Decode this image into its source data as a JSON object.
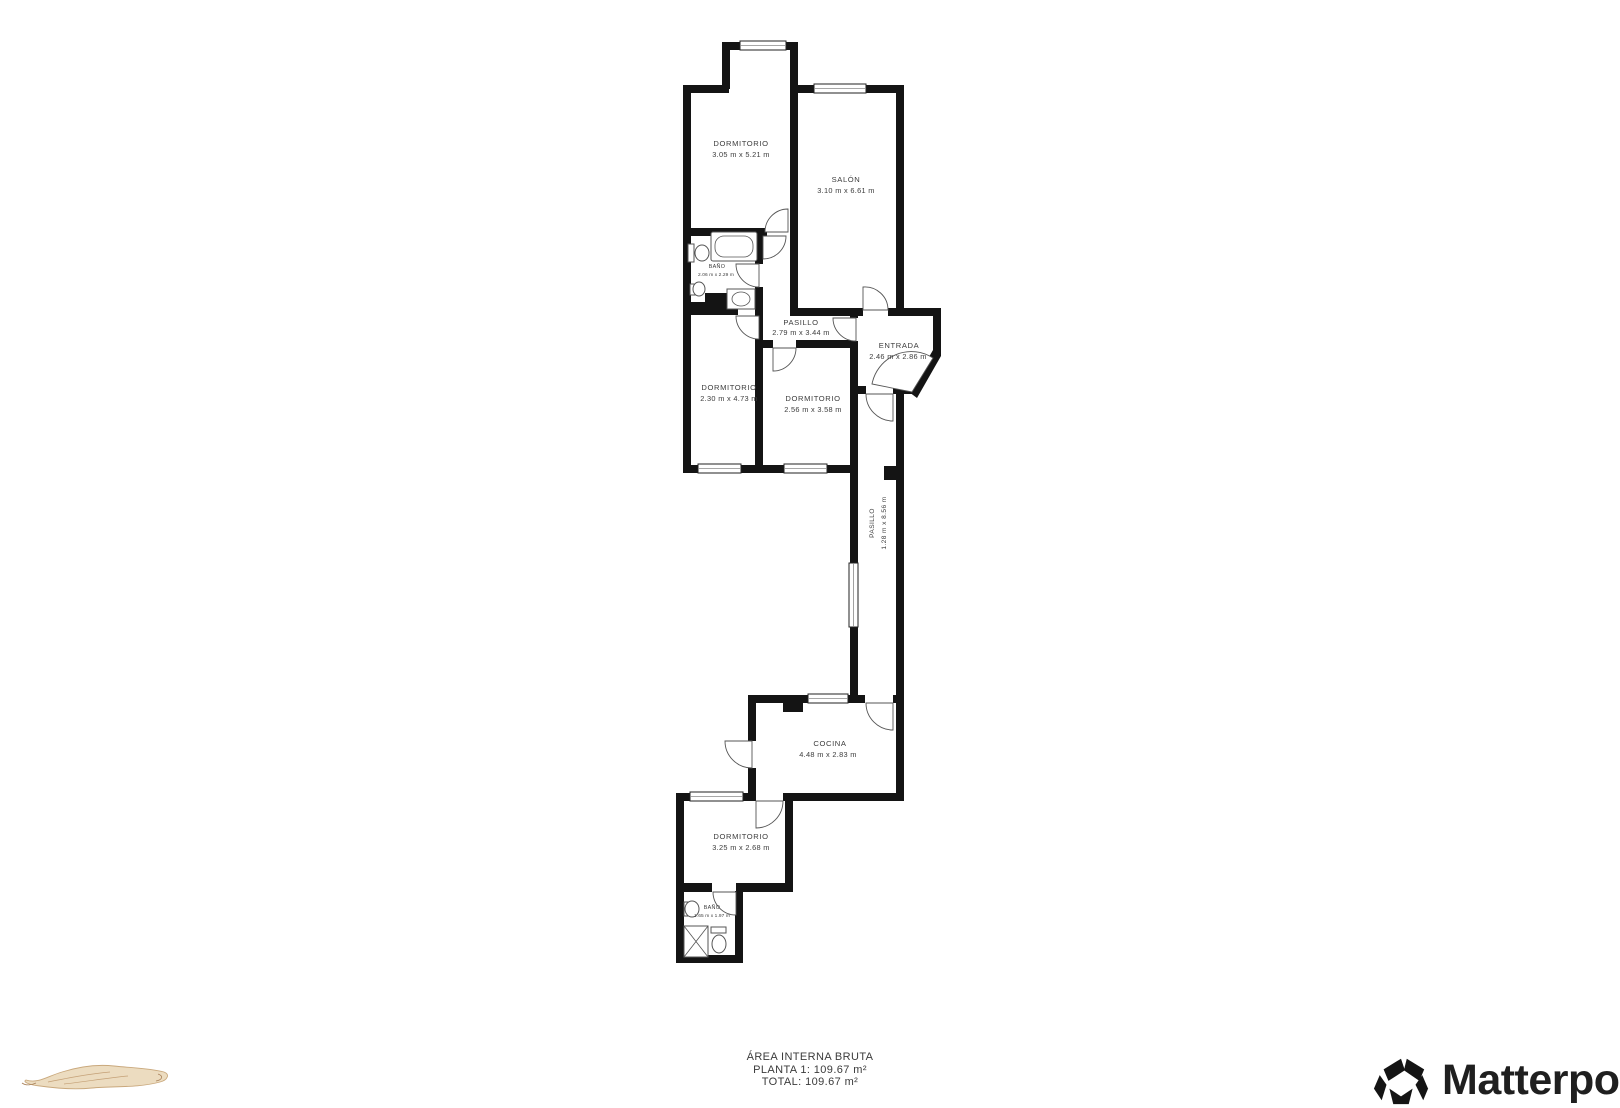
{
  "floorplan": {
    "rooms": [
      {
        "name": "DORMITORIO",
        "dims": "3.05 m x 5.21 m"
      },
      {
        "name": "SALÓN",
        "dims": "3.10 m x 6.61 m"
      },
      {
        "name": "BAÑO",
        "dims": "2.06 m x 2.29 m"
      },
      {
        "name": "PASILLO",
        "dims": "2.79 m x 3.44 m"
      },
      {
        "name": "ENTRADA",
        "dims": "2.46 m x 2.86 m"
      },
      {
        "name": "DORMITORIO",
        "dims": "2.30 m x 4.73 m"
      },
      {
        "name": "DORMITORIO",
        "dims": "2.56 m x 3.58 m"
      },
      {
        "name": "PASILLO",
        "dims": "1.28 m x 8.56 m"
      },
      {
        "name": "COCINA",
        "dims": "4.48 m x 2.83 m"
      },
      {
        "name": "DORMITORIO",
        "dims": "3.25 m x 2.68 m"
      },
      {
        "name": "BAÑO",
        "dims": "1.65 m x 1.97 m"
      }
    ],
    "footer": {
      "line1": "ÁREA INTERNA BRUTA",
      "line2": "PLANTA 1: 109.67 m²",
      "line3_partial": "TOTAL: 109.67 m²"
    },
    "logo": {
      "name": "Matterport",
      "registered": "®"
    },
    "colors": {
      "walls": "#141414",
      "label_text": "#3c3c3c",
      "sketch_fill": "#ecdcc0",
      "sketch_stroke": "#c9a87c"
    }
  }
}
